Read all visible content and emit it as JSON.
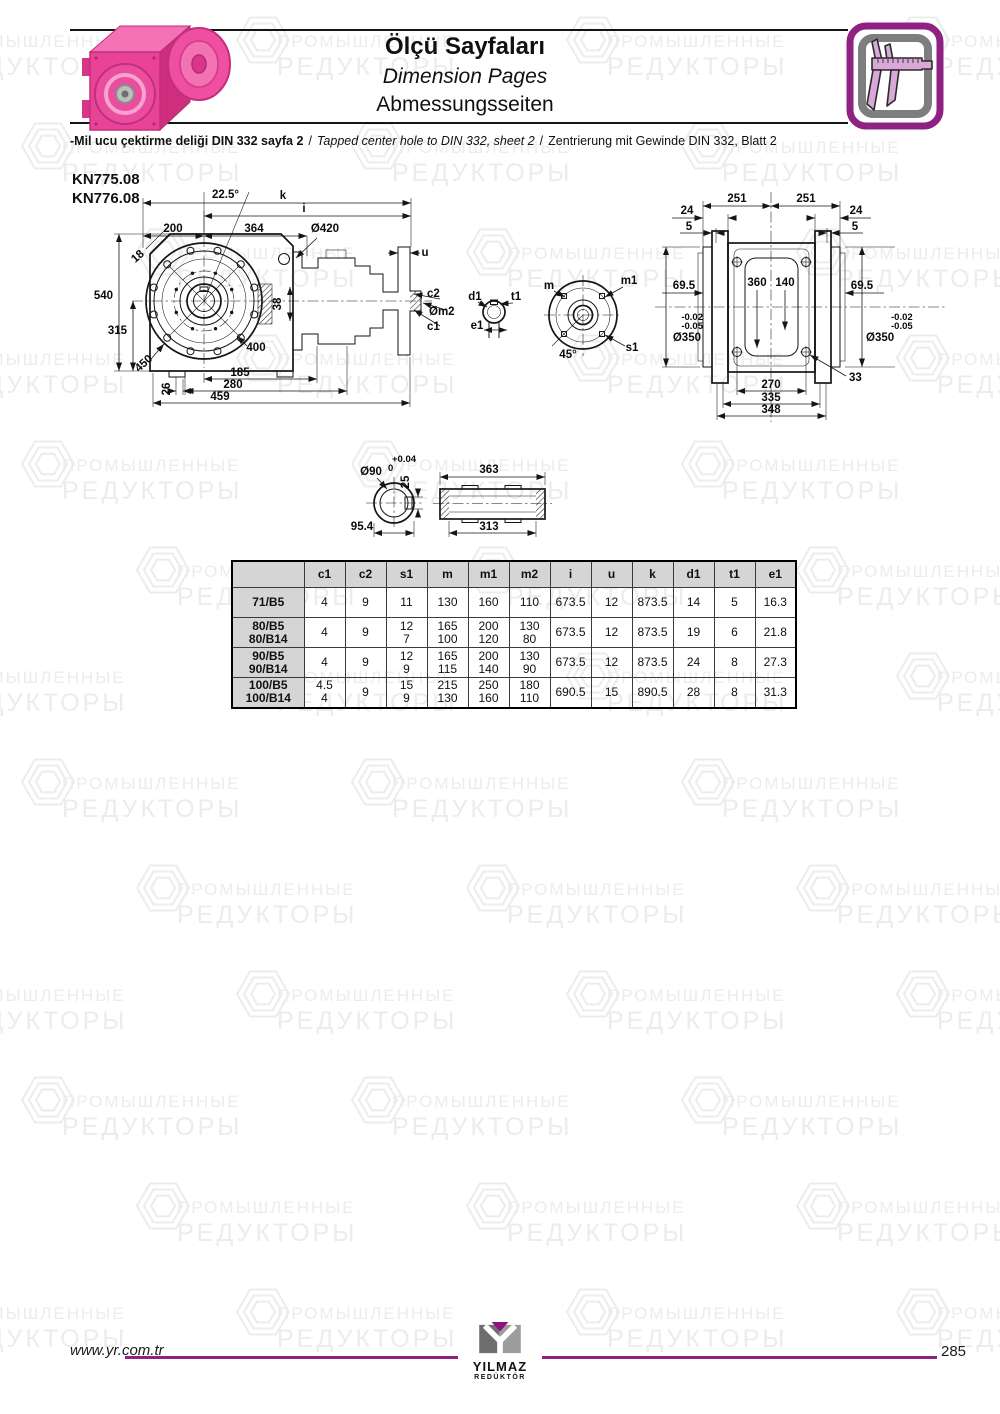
{
  "watermark": {
    "line1": "ПРОМЫШЛЕННЫЕ",
    "line2": "РЕДУКТОРЫ"
  },
  "header": {
    "title_tr": "Ölçü Sayfaları",
    "title_en": "Dimension Pages",
    "title_de": "Abmessungsseiten"
  },
  "note": {
    "tr": "-Mil ucu çektirme deliği DIN 332 sayfa 2",
    "sep1": "/",
    "en": "Tapped center hole to DIN 332, sheet 2",
    "sep2": "/",
    "de": "Zentrierung mit Gewinde DIN 332, Blatt 2"
  },
  "models": [
    "KN775.08",
    "KN776.08"
  ],
  "drawings": {
    "front": {
      "k": "k",
      "i": "i",
      "angle": "22.5°",
      "d200": "200",
      "d364": "364",
      "dia420": "Ø420",
      "d18": "18",
      "u": "u",
      "c2": "c2",
      "om2": "Øm2",
      "c1": "c1",
      "d540": "540",
      "d315": "315",
      "d450": "450",
      "d400": "400",
      "d38": "38",
      "d26": "26",
      "d185": "185",
      "d280": "280",
      "d459": "459"
    },
    "shaft_end": {
      "d1": "d1",
      "t1": "t1",
      "e1": "e1"
    },
    "flange_circle": {
      "m": "m",
      "m1": "m1",
      "s1": "s1",
      "angle": "45°"
    },
    "side": {
      "l251": "251",
      "r251": "251",
      "l24": "24",
      "l5": "5",
      "r24": "24",
      "r5": "5",
      "l695": "69.5",
      "r695": "69.5",
      "d360": "360",
      "d140": "140",
      "ltol1": "-0.02",
      "ltol2": "-0.05",
      "ldia": "Ø350",
      "rtol1": "-0.02",
      "rtol2": "-0.05",
      "rdia": "Ø350",
      "d33": "33",
      "d270": "270",
      "d335": "335",
      "d348": "348"
    },
    "hollow": {
      "dia": "Ø90",
      "tolp": "+0.04",
      "tol0": "0",
      "d25": "25",
      "d954": "95.4",
      "d363": "363",
      "d313": "313"
    }
  },
  "table": {
    "headers": [
      "",
      "c1",
      "c2",
      "s1",
      "m",
      "m1",
      "m2",
      "i",
      "u",
      "k",
      "d1",
      "t1",
      "e1"
    ],
    "rows": [
      {
        "model": "71/B5",
        "values": [
          "4",
          "9",
          "11",
          "130",
          "160",
          "110",
          "673.5",
          "12",
          "873.5",
          "14",
          "5",
          "16.3"
        ]
      },
      {
        "model": "80/B5\n80/B14",
        "values": [
          "4",
          "9",
          "12\n7",
          "165\n100",
          "200\n120",
          "130\n80",
          "673.5",
          "12",
          "873.5",
          "19",
          "6",
          "21.8"
        ]
      },
      {
        "model": "90/B5\n90/B14",
        "values": [
          "4",
          "9",
          "12\n9",
          "165\n115",
          "200\n140",
          "130\n90",
          "673.5",
          "12",
          "873.5",
          "24",
          "8",
          "27.3"
        ]
      },
      {
        "model": "100/B5\n100/B14",
        "values": [
          "4.5\n4",
          "9",
          "15\n9",
          "215\n130",
          "250\n160",
          "180\n110",
          "690.5",
          "15",
          "890.5",
          "28",
          "8",
          "31.3"
        ]
      }
    ]
  },
  "footer": {
    "url": "www.yr.com.tr",
    "page": "285",
    "logo_line1": "YILMAZ",
    "logo_line2": "REDÜKTÖR"
  },
  "colors": {
    "accent": "#8e2181",
    "pink": "#e94397",
    "table_gray": "#d5d5d5"
  }
}
